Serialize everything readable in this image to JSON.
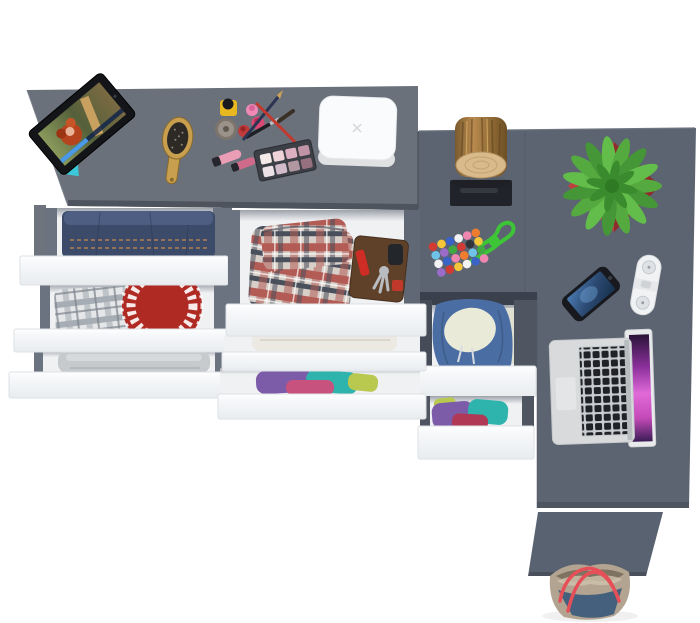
{
  "scene": {
    "subject": "top view of a gray corner desk and dresser with open white drawers filled with clothes and accessories",
    "background_color": "#ffffff"
  },
  "items": [
    "tablet",
    "hairbrush",
    "cosmetics",
    "eyeshadow-palette",
    "white-box",
    "folded-jeans",
    "plaid-shirt",
    "red-plate",
    "gray-towel",
    "plaid-shorts",
    "wallet-with-keys",
    "white-towel",
    "colorful-clothes",
    "bead-necklace",
    "wood-stump",
    "potted-succulent",
    "smartphone",
    "power-strip",
    "laptop",
    "blue-hoodie",
    "front-panel",
    "tote-bag"
  ],
  "palette": {
    "bg": "#ffffff",
    "desk_left": "#6a717b",
    "desk_left_edge": "#4e545e",
    "desk_right": "#5c6471",
    "desk_seam": "#525a66",
    "cabinet_band": "#3a414c",
    "panel_front": "#596270",
    "drawer_front": "#fbfcfd",
    "drawer_front_line": "#dde0e4",
    "drawer_interior": "#f0f1f3",
    "rail": "#6b7380",
    "rail_dark": "#4b525c",
    "leg": "#6d747e",
    "denim": "#3b4b69",
    "denim_light": "#4d5e82",
    "stitch": "#c9894a",
    "towel_gray": "#c6cacd",
    "towel_white": "#ece9e2",
    "red_plate": "#b02a24",
    "hoodie": "#4a6da3",
    "hoodie_lining": "#e9ead8",
    "wallet": "#5f4129",
    "knife": "#cd2d24",
    "keys_metal": "#b9bdc2",
    "stump_bark": "#9c7440",
    "stump_face": "#d9ba8b",
    "niche": "#202329",
    "pot_light": "#bc4140",
    "pot_dark": "#8f2b2b",
    "plant_center": "#2e7a24",
    "cord": "#3ec437",
    "phone": "#17191e",
    "strip": "#f1f2f3",
    "strip_socket": "#dfe2e5",
    "laptop_body": "#d8dadc",
    "laptop_keys": "#202227",
    "tablet_body": "#141519",
    "hair_red": "#b5431d",
    "skin": "#e8b49a",
    "stand_cyan": "#3bc8d8",
    "brush_wood": "#c79f4e",
    "bristles": "#2d2a25",
    "box": "#fafbfc",
    "box_side": "#dfe1e3",
    "bag_body": "#b2a490",
    "bag_inner": "#7e7260",
    "bag_blue": "#45607d",
    "bag_handle": "#e74f58",
    "plaid_red_base": "#d8cfc8",
    "plaid_red_stripe": "#b35c55",
    "plaid_red_dark": "#49505c",
    "plaid_gray_base": "#e4e6e8",
    "plaid_gray_stripe": "#a7adb4",
    "beads": [
      "#d23b33",
      "#3a63c8",
      "#6fc3e8",
      "#f5c53a",
      "#ef86b0",
      "#f2f2f2",
      "#42a842",
      "#ef7c2f",
      "#9a6cc8",
      "#30343a"
    ],
    "eyeshadow": [
      "#f3e9e6",
      "#eed3d8",
      "#dcb0c0",
      "#c193a6",
      "#ece2e6",
      "#d3bcc9",
      "#b197a0",
      "#96707f"
    ],
    "clothes": [
      "#7c5ca8",
      "#2eb4ad",
      "#c8527e",
      "#b9c84e",
      "#b03a55"
    ]
  }
}
